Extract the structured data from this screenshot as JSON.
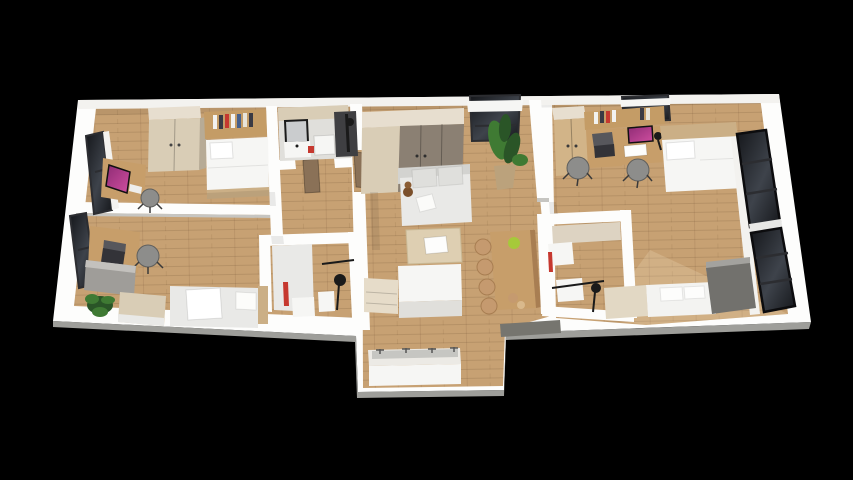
{
  "scene": {
    "kind": "3d-floor-plan-render",
    "description": "isometric cutaway render of an apartment on black background",
    "visible_objects": [
      "bed",
      "bed",
      "bed",
      "bed",
      "desk",
      "desk",
      "desk",
      "desk",
      "office-chair",
      "office-chair",
      "office-chair",
      "office-chair",
      "wardrobe",
      "wardrobe",
      "closet",
      "sofa",
      "coffee-table",
      "bar-counter",
      "bar-stool",
      "bar-stool",
      "bar-stool",
      "bar-stool",
      "kitchen-island",
      "kitchen-counter",
      "plant",
      "plant",
      "shower",
      "shower",
      "sink",
      "mirror",
      "window",
      "window",
      "window",
      "window",
      "window"
    ]
  },
  "colors": {
    "bg": "#000000",
    "wall": "#fdfdfc",
    "wallInner": "#f3f2ef",
    "wallShade": "#e0dfdb",
    "wallEdge": "#c6c5c1",
    "grayCap": "#76756f",
    "floor": "#c7a173",
    "floorLight": "#d6b88c",
    "woodDesk": "#c79e6a",
    "woodShelf": "#c49c66",
    "woodTrim": "#cbaf86",
    "beige": "#d9cdb6",
    "beigeLight": "#e7decf",
    "taupe": "#8b8073",
    "grayCabinet": "#9f9d99",
    "grayUnit": "#72716d",
    "grayUnitTop": "#a3a29e",
    "whiteFurn": "#f6f6f4",
    "whiteShade": "#e9e9e7",
    "sofaBack": "#d3d3d0",
    "chair": "#8d8d8b",
    "chairDark": "#5f5f5d",
    "screenA": "#8e2b74",
    "screenB": "#d04fa0",
    "laptop": "#333338",
    "plant": "#3f7a33",
    "plantDark": "#2a5527",
    "pot": "#bba27c",
    "glass": "#15171b",
    "glassLight": "#3e434b",
    "frame": "#2c2d31",
    "doorBrown": "#8a7157",
    "red": "#c6382f",
    "lime": "#a6c93a",
    "stool": "#c59a6f",
    "stoolDark": "#a87e52",
    "counter": "#eceae5",
    "sinkGray": "#c6c6c2",
    "black": "#1a1a1a"
  }
}
